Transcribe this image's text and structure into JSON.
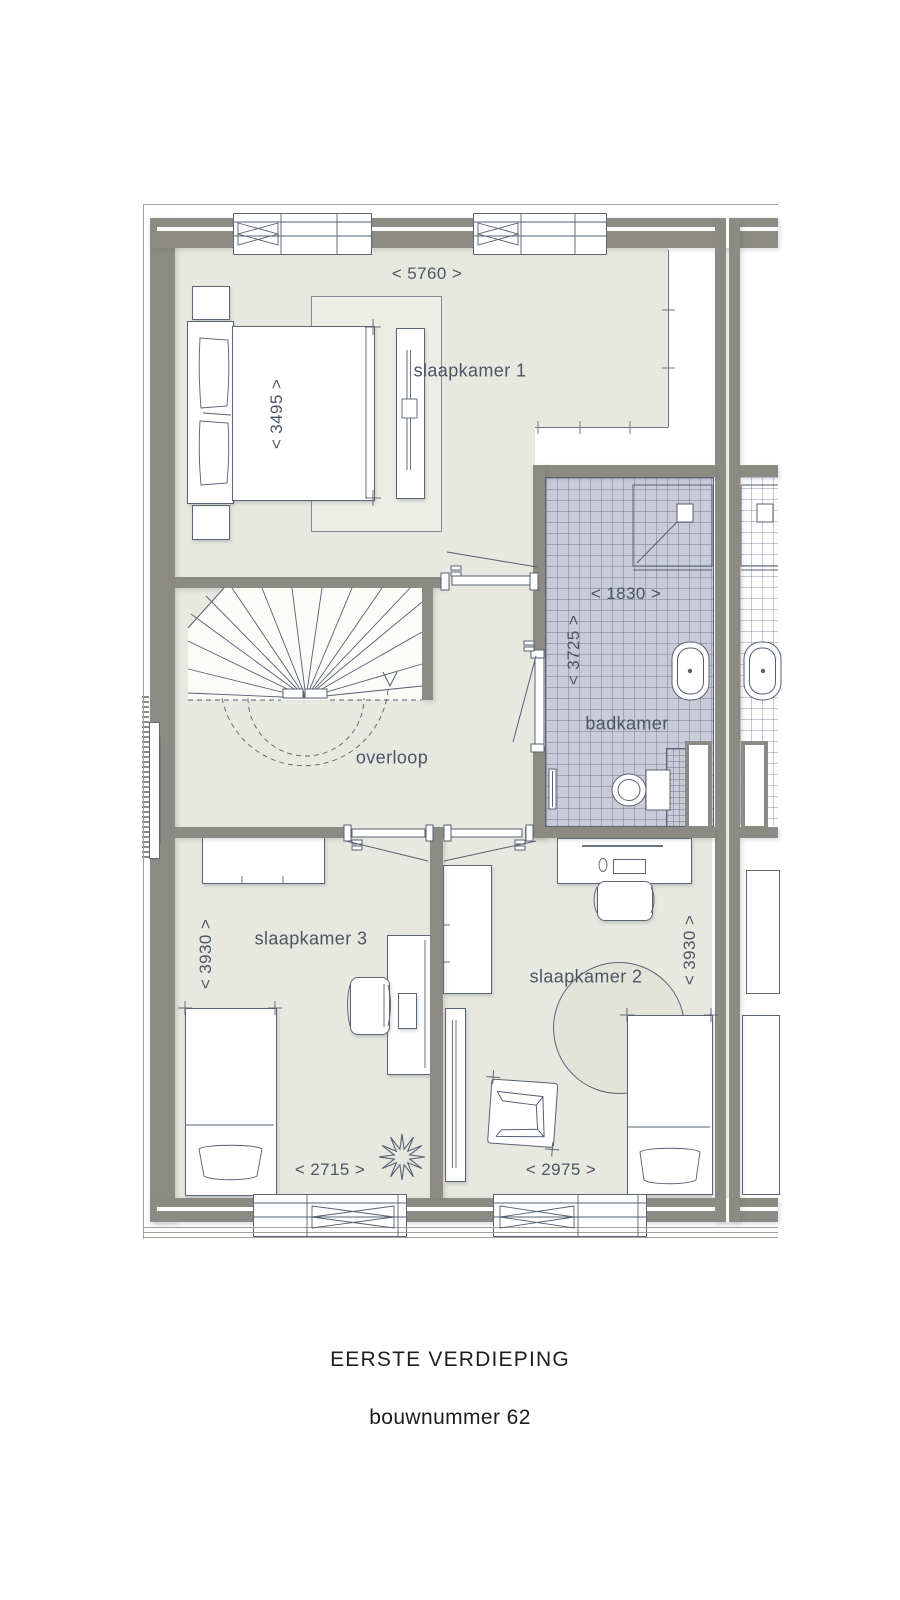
{
  "caption": {
    "floor": "EERSTE VERDIEPING",
    "unit": "bouwnummer 62"
  },
  "rooms": {
    "slaapkamer1": {
      "label": "slaapkamer 1",
      "dim_width": "< 5760 >",
      "dim_depth": "< 3495 >"
    },
    "overloop": {
      "label": "overloop"
    },
    "badkamer": {
      "label": "badkamer",
      "dim_width": "< 1830 >",
      "dim_depth": "< 3725 >"
    },
    "slaapkamer3": {
      "label": "slaapkamer 3",
      "dim_width": "< 2715 >",
      "dim_depth": "< 3930 >"
    },
    "slaapkamer2": {
      "label": "slaapkamer 2",
      "dim_width": "< 2975 >",
      "dim_depth": "< 3930 >"
    }
  },
  "colors": {
    "wall": "#8b8b83",
    "floor": "#e7e8e0",
    "tile": "#c9cbd7",
    "tile_grid": "#a9adc0",
    "line": "#566070",
    "label_text": "#4b5663",
    "caption_text": "#1d1d1b"
  }
}
